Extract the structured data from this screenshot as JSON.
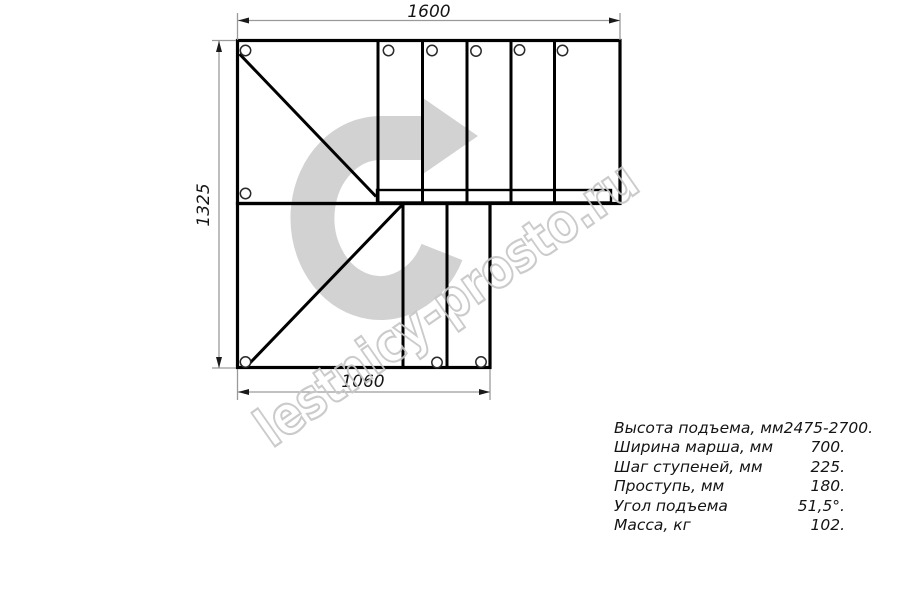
{
  "drawing": {
    "dim_top": "1600",
    "dim_left": "1325",
    "dim_bottom": "1060"
  },
  "watermark": {
    "text": "lestnicy-prosto.ru"
  },
  "specs": {
    "rows": [
      {
        "label": "Высота подъема, мм",
        "value": "2475-2700."
      },
      {
        "label": "Ширина марша, мм",
        "value": "700."
      },
      {
        "label": "Шаг ступеней, мм",
        "value": "225."
      },
      {
        "label": "Проступь, мм",
        "value": "180."
      },
      {
        "label": "Угол подъема",
        "value": "51,5°."
      },
      {
        "label": "Масса, кг",
        "value": "102."
      }
    ]
  },
  "colors": {
    "line": "#000000",
    "dimension": "#9a9a9a",
    "arrow": "#d2d2d2",
    "watermark": "#c6c6c6"
  }
}
